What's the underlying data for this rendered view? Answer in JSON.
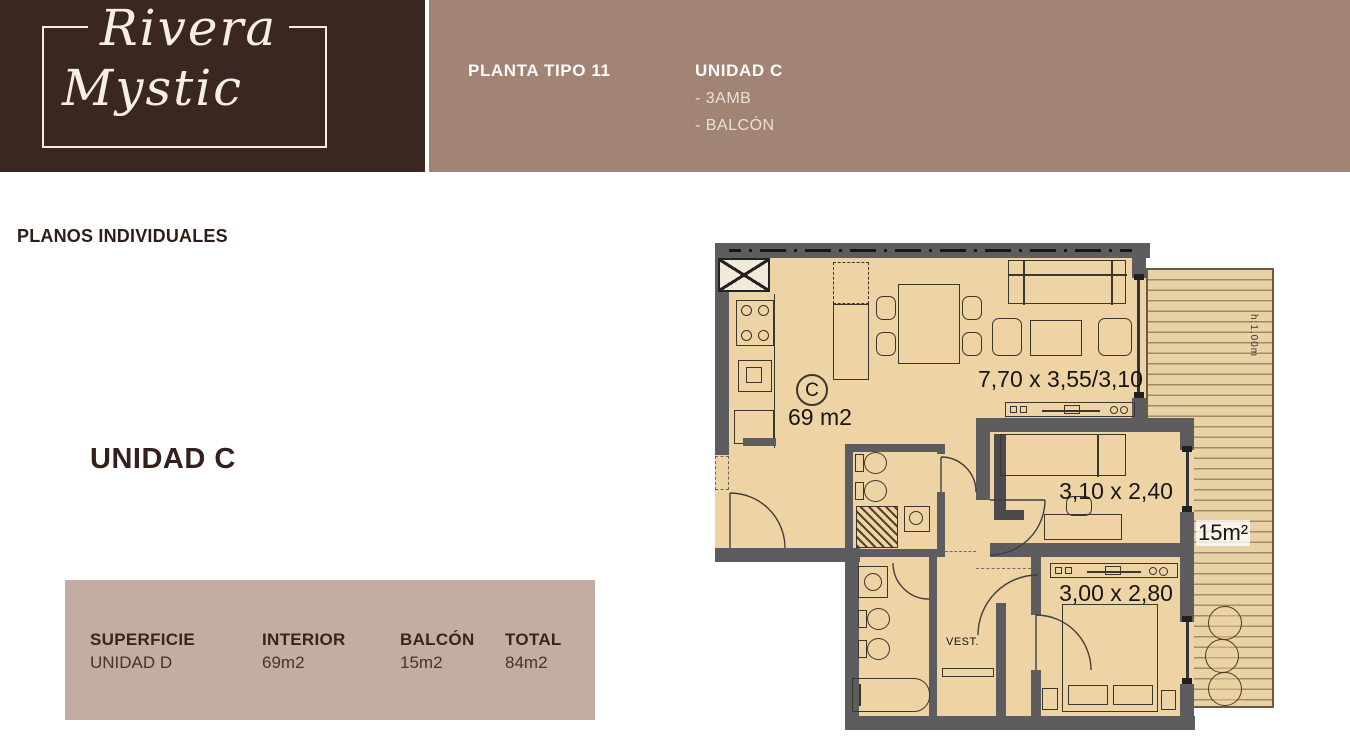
{
  "colors": {
    "brand_bg": "#3b2722",
    "band_bg": "#a28474",
    "panel_bg": "#c3aca1",
    "heading_text": "#33201a",
    "logo_text": "#f6f0e0",
    "plan_floor": "#eed3a5",
    "plan_wall": "#5d5d60"
  },
  "brand": {
    "name_line1": "Rivera",
    "name_line2": "Mystic"
  },
  "header": {
    "plan_type": "PLANTA TIPO 11",
    "unit_name": "UNIDAD C",
    "features": [
      "- 3AMB",
      "- BALCÓN"
    ]
  },
  "section": {
    "heading": "PLANOS INDIVIDUALES",
    "unit_label": "UNIDAD C"
  },
  "summary_table": {
    "columns": [
      {
        "header": "SUPERFICIE",
        "value": "UNIDAD D"
      },
      {
        "header": "INTERIOR",
        "value": "69m2"
      },
      {
        "header": "BALCÓN",
        "value": "15m2"
      },
      {
        "header": "TOTAL",
        "value": "84m2"
      }
    ]
  },
  "floorplan": {
    "unit_letter": "C",
    "interior_area": "69 m2",
    "living_dim": "7,70 x 3,55/3,10",
    "bedroom1_dim": "3,10 x 2,40",
    "bedroom2_dim": "3,00 x 2,80",
    "balcony_area": "15m²",
    "closet_label": "VEST.",
    "railing_height": "h:1,00m"
  }
}
